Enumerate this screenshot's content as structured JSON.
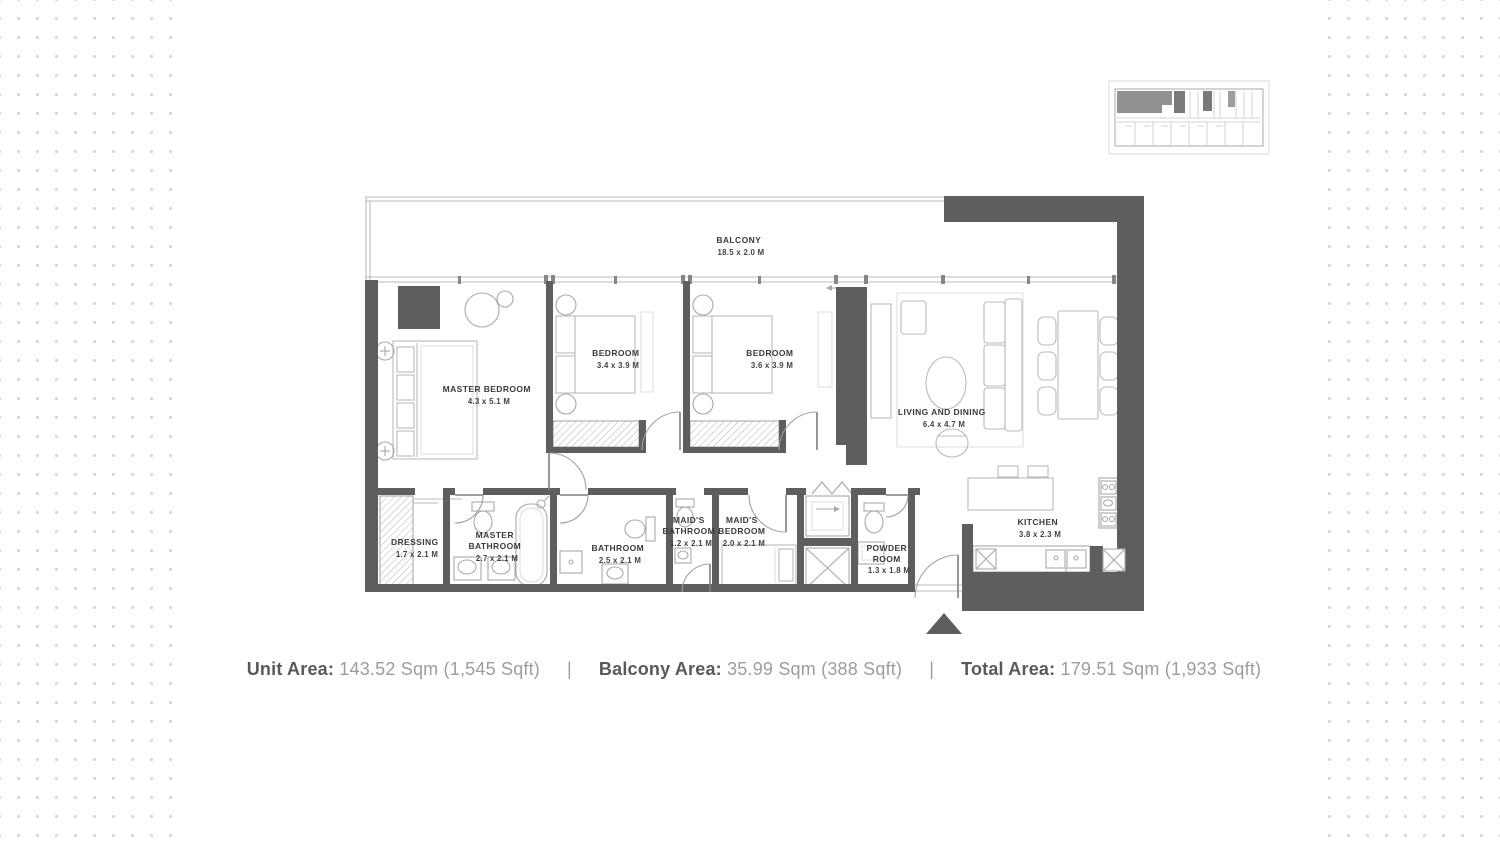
{
  "plan": {
    "balcony": {
      "name": "BALCONY",
      "dims": "18.5 x 2.0 M"
    },
    "master_bedroom": {
      "name": "MASTER BEDROOM",
      "dims": "4.3 x 5.1 M"
    },
    "bedroom_1": {
      "name": "BEDROOM",
      "dims": "3.4 x 3.9 M"
    },
    "bedroom_2": {
      "name": "BEDROOM",
      "dims": "3.6 x 3.9 M"
    },
    "living_dining": {
      "name": "LIVING AND DINING",
      "dims": "6.4 x 4.7 M"
    },
    "kitchen": {
      "name": "KITCHEN",
      "dims": "3.8 x 2.3 M"
    },
    "dressing": {
      "name": "DRESSING",
      "dims": "1.7 x 2.1 M"
    },
    "master_bathroom": {
      "line1": "MASTER",
      "line2": "BATHROOM",
      "dims": "2.7 x 2.1 M"
    },
    "bathroom": {
      "name": "BATHROOM",
      "dims": "2.5 x 2.1 M"
    },
    "maids_bathroom": {
      "line1": "MAID'S",
      "line2": "BATHROOM",
      "dims": "1.2 x 2.1 M"
    },
    "maids_bedroom": {
      "line1": "MAID'S",
      "line2": "BEDROOM",
      "dims": "2.0 x 2.1 M"
    },
    "powder_room": {
      "line1": "POWDER",
      "line2": "ROOM",
      "dims": "1.3 x 1.8 M"
    }
  },
  "info_bar": {
    "separator": "|",
    "items": [
      {
        "label": "Unit Area:",
        "value": "143.52 Sqm (1,545 Sqft)"
      },
      {
        "label": "Balcony Area:",
        "value": "35.99 Sqm (388 Sqft)"
      },
      {
        "label": "Total Area:",
        "value": "179.51 Sqm (1,933 Sqft)"
      }
    ]
  },
  "colors": {
    "wall": "#5d5e60",
    "furniture_line": "#b9bbbd",
    "fixture_line": "#a7a9ab",
    "room_label_text": "#393b3d",
    "info_label": "#57595c",
    "info_value": "#9b9da0",
    "background_dot": "#d6d7d9",
    "keyplan_highlight": "#8f9193"
  }
}
